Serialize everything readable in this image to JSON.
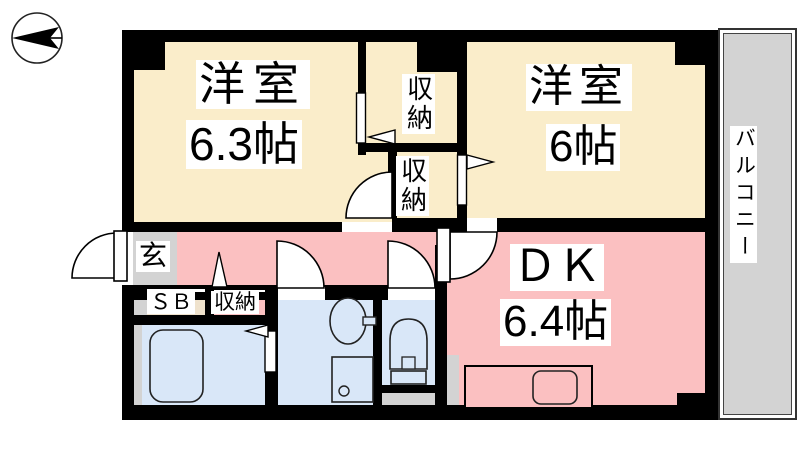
{
  "plan": {
    "type": "floorplan",
    "compass": {
      "icon": "north-arrow-pointing-left"
    },
    "rooms": {
      "bedroom_left": {
        "label": "洋室",
        "size": "6.3帖"
      },
      "bedroom_right": {
        "label": "洋室",
        "size": "6帖"
      },
      "dining_kitchen": {
        "label": "ＤＫ",
        "size": "6.4帖"
      },
      "balcony": {
        "label": "バルコニー"
      },
      "entrance": {
        "label": "玄"
      },
      "shoe_box": {
        "label": "ＳＢ"
      },
      "hall_storage": {
        "label": "収納"
      },
      "closet_upper": {
        "label": "収納"
      },
      "closet_lower": {
        "label": "収納"
      }
    },
    "fixtures": {
      "bathtub": "bathtub-icon",
      "wash_basin": "wash-basin-icon",
      "washing_machine_pan": "washing-machine-pan-icon",
      "toilet": "toilet-icon",
      "kitchen_counter": "kitchen-counter-icon",
      "kitchen_sink": "kitchen-sink-icon"
    },
    "colors": {
      "wall": "#000000",
      "bedroom_floor": "#FAEDCA",
      "dk_floor": "#FBC0C1",
      "wet_area_floor": "#D9E7F8",
      "entrance_floor": "#D3D3D3",
      "balcony_floor": "#D3D3D3",
      "shoe_box_floor": "#EFE2CC"
    }
  }
}
